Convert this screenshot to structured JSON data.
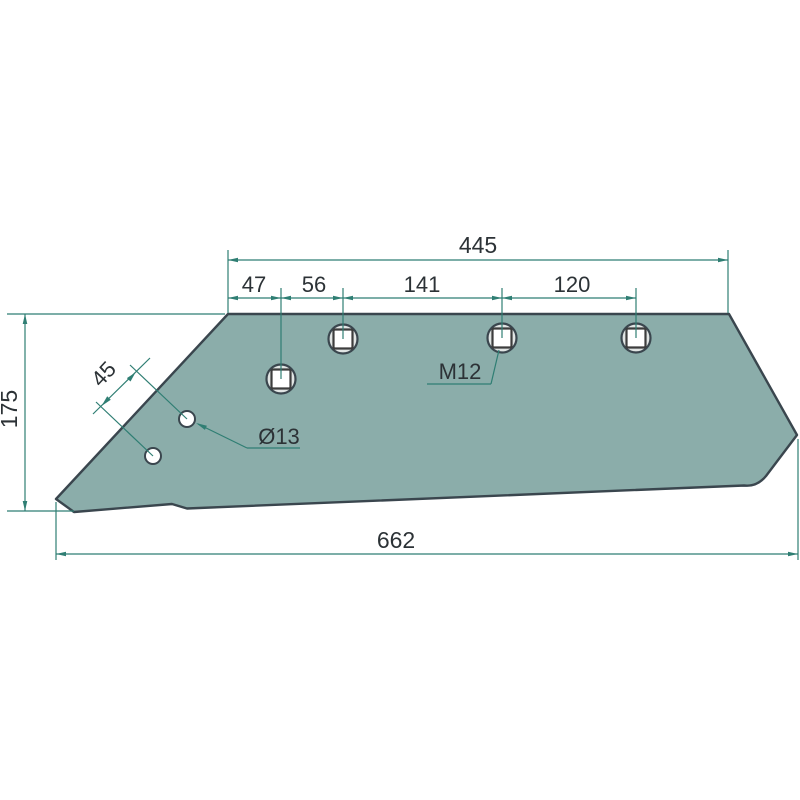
{
  "drawing": {
    "dim_top_total": "445",
    "dim_seg_1": "47",
    "dim_seg_2": "56",
    "dim_seg_3": "141",
    "dim_seg_4": "120",
    "dim_height": "175",
    "dim_hole_spacing": "45",
    "dim_bottom_total": "662",
    "label_thread": "M12",
    "label_hole_diameter": "Ø13",
    "colors": {
      "plate_fill": "#8badaa",
      "plate_outline": "#3a464e",
      "dimension_line": "#2f7e73",
      "dimension_text": "#2c3236",
      "hole_ring_fill": "#e1e5e4",
      "hole_fill": "#ffffff",
      "square_outline": "#3d3d3d"
    }
  }
}
